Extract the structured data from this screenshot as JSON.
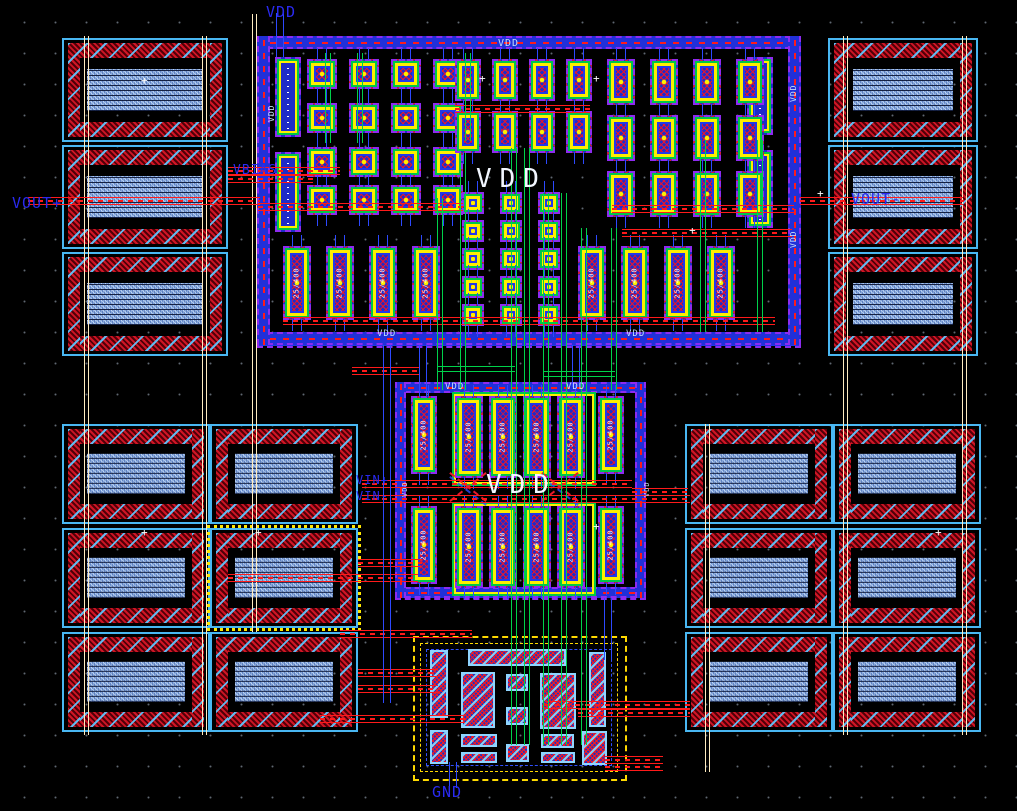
{
  "canvas": {
    "width": 1017,
    "height": 811,
    "description": "IC layout editor canvas, black background with dot grid"
  },
  "colors": {
    "background": "#000000",
    "grid_dot": "#9fb4c8",
    "purple": "#8d2bf0",
    "blue": "#2338e8",
    "light_blue": "#49b7f2",
    "green": "#00c845",
    "yellow": "#ffee00",
    "red": "#ff1a1a",
    "dark_red": "#500008",
    "cream": "#ffecc0",
    "white": "#f2f6ff",
    "label_blue": "#2a2af0",
    "select_yellow": "#ffe800"
  },
  "device_label": "25/400",
  "marker_glyph": "+",
  "texts": [
    {
      "label": "VDD",
      "x": 266,
      "y": 5,
      "size": 15,
      "color": "blue",
      "name": "net-label-vdd-top"
    },
    {
      "label": "VDD",
      "x": 498,
      "y": 39,
      "size": 10,
      "color": "lt",
      "name": "rail-label-vdd-top"
    },
    {
      "label": "VBIAS",
      "x": 233,
      "y": 164,
      "size": 13,
      "color": "blue",
      "name": "net-label-vbias"
    },
    {
      "label": "VOUT+",
      "x": 12,
      "y": 196,
      "size": 15,
      "color": "blue",
      "name": "net-label-vout-plus"
    },
    {
      "label": "VOUT-",
      "x": 851,
      "y": 192,
      "size": 15,
      "color": "blue",
      "name": "net-label-vout-minus"
    },
    {
      "label": "VDD",
      "x": 476,
      "y": 166,
      "size": 26,
      "color": "white",
      "spacing": 8,
      "name": "power-label-vdd-topblock"
    },
    {
      "label": "VDD",
      "x": 486,
      "y": 472,
      "size": 26,
      "color": "white",
      "spacing": 8,
      "name": "power-label-vdd-midblock"
    },
    {
      "label": "VIN+",
      "x": 356,
      "y": 474,
      "size": 12,
      "color": "blue",
      "name": "net-label-vin-plus"
    },
    {
      "label": "VIN-",
      "x": 356,
      "y": 490,
      "size": 12,
      "color": "blue",
      "name": "net-label-vin-minus"
    },
    {
      "label": "GND",
      "x": 432,
      "y": 785,
      "size": 15,
      "color": "blue",
      "name": "net-label-gnd"
    },
    {
      "label": "VDD",
      "x": 377,
      "y": 330,
      "size": 9,
      "color": "lt",
      "name": "rail-label-vdd-bottomleft"
    },
    {
      "label": "VDD",
      "x": 626,
      "y": 330,
      "size": 9,
      "color": "lt",
      "name": "rail-label-vdd-bottomright"
    },
    {
      "label": "VDD",
      "x": 445,
      "y": 383,
      "size": 9,
      "color": "lt",
      "name": "rail-label-vdd-midleft"
    },
    {
      "label": "VDD",
      "x": 566,
      "y": 383,
      "size": 9,
      "color": "lt",
      "name": "rail-label-vdd-midright"
    },
    {
      "label": "VDD",
      "x": 790,
      "y": 102,
      "size": 8,
      "color": "lt",
      "rot": -90,
      "name": "rail-label-vdd-right1"
    },
    {
      "label": "VDD",
      "x": 790,
      "y": 248,
      "size": 8,
      "color": "lt",
      "rot": -90,
      "name": "rail-label-vdd-right2"
    },
    {
      "label": "VDD",
      "x": 268,
      "y": 122,
      "size": 8,
      "color": "lt",
      "rot": -90,
      "name": "rail-label-vdd-left1"
    },
    {
      "label": "VDD",
      "x": 402,
      "y": 497,
      "size": 7,
      "color": "lt",
      "rot": -90,
      "name": "port-label-mid-left"
    },
    {
      "label": "VDD",
      "x": 644,
      "y": 497,
      "size": 7,
      "color": "lt",
      "rot": -90,
      "name": "port-label-mid-right"
    }
  ],
  "top_block_cells": {
    "bias": [
      [
        275,
        57,
        26,
        80
      ],
      [
        275,
        152,
        26,
        80
      ],
      [
        747,
        57,
        26,
        78
      ],
      [
        747,
        150,
        26,
        78
      ]
    ],
    "sq": {
      "w": 30,
      "h": 30,
      "pts": [
        [
          307,
          59
        ],
        [
          349,
          59
        ],
        [
          391,
          59
        ],
        [
          433,
          59
        ],
        [
          307,
          103
        ],
        [
          349,
          103
        ],
        [
          391,
          103
        ],
        [
          433,
          103
        ],
        [
          307,
          147
        ],
        [
          349,
          147
        ],
        [
          391,
          147
        ],
        [
          433,
          147
        ],
        [
          307,
          185
        ],
        [
          349,
          185
        ],
        [
          391,
          185
        ],
        [
          433,
          185
        ]
      ]
    },
    "vcell_center": {
      "w": 26,
      "h": 42,
      "pts": [
        [
          455,
          59
        ],
        [
          492,
          59
        ],
        [
          529,
          59
        ],
        [
          566,
          59
        ],
        [
          455,
          111
        ],
        [
          492,
          111
        ],
        [
          529,
          111
        ],
        [
          566,
          111
        ]
      ]
    },
    "sq_small": {
      "w": 22,
      "h": 22,
      "pts": [
        [
          462,
          192
        ],
        [
          500,
          192
        ],
        [
          538,
          192
        ],
        [
          462,
          220
        ],
        [
          500,
          220
        ],
        [
          538,
          220
        ],
        [
          462,
          248
        ],
        [
          500,
          248
        ],
        [
          538,
          248
        ],
        [
          462,
          276
        ],
        [
          500,
          276
        ],
        [
          538,
          276
        ],
        [
          462,
          304
        ],
        [
          500,
          304
        ],
        [
          538,
          304
        ]
      ]
    },
    "vcell_right": {
      "w": 28,
      "h": 46,
      "pts": [
        [
          607,
          59
        ],
        [
          650,
          59
        ],
        [
          693,
          59
        ],
        [
          736,
          59
        ],
        [
          607,
          115
        ],
        [
          650,
          115
        ],
        [
          693,
          115
        ],
        [
          736,
          115
        ],
        [
          607,
          171
        ],
        [
          650,
          171
        ],
        [
          693,
          171
        ],
        [
          736,
          171
        ]
      ]
    },
    "tall": {
      "w": 28,
      "h": 74,
      "y": 246,
      "xs": [
        283,
        326,
        369,
        412,
        578,
        621,
        664,
        707
      ]
    }
  },
  "middle_block_cells": {
    "narrow": {
      "w": 26,
      "h": 78,
      "pts": [
        [
          411,
          396
        ],
        [
          598,
          396
        ],
        [
          411,
          506
        ],
        [
          598,
          506
        ]
      ]
    },
    "wide": {
      "w": 28,
      "h": 82,
      "pts": [
        [
          455,
          396
        ],
        [
          489,
          396
        ],
        [
          523,
          396
        ],
        [
          557,
          396
        ],
        [
          455,
          506
        ],
        [
          489,
          506
        ],
        [
          523,
          506
        ],
        [
          557,
          506
        ]
      ]
    },
    "rings": [
      [
        452,
        392,
        140,
        90
      ],
      [
        452,
        502,
        140,
        90
      ]
    ]
  },
  "bottom_block_cells": [
    [
      430,
      650,
      18,
      68
    ],
    [
      430,
      730,
      18,
      34
    ],
    [
      468,
      649,
      98,
      17
    ],
    [
      461,
      672,
      34,
      56
    ],
    [
      506,
      674,
      22,
      17
    ],
    [
      506,
      707,
      22,
      18
    ],
    [
      540,
      673,
      36,
      56
    ],
    [
      589,
      652,
      17,
      75
    ],
    [
      461,
      734,
      36,
      13
    ],
    [
      461,
      752,
      36,
      11
    ],
    [
      506,
      744,
      23,
      18
    ],
    [
      541,
      734,
      33,
      14
    ],
    [
      541,
      752,
      34,
      11
    ],
    [
      582,
      731,
      25,
      34
    ]
  ],
  "capacitors": {
    "units": [
      [
        62,
        38,
        166,
        104
      ],
      [
        62,
        145,
        166,
        104
      ],
      [
        62,
        252,
        166,
        104
      ],
      [
        828,
        38,
        150,
        104
      ],
      [
        828,
        145,
        150,
        104
      ],
      [
        828,
        252,
        150,
        104
      ],
      [
        62,
        424,
        148,
        100
      ],
      [
        210,
        424,
        148,
        100
      ],
      [
        62,
        528,
        148,
        100
      ],
      [
        210,
        528,
        148,
        100
      ],
      [
        62,
        632,
        148,
        100
      ],
      [
        210,
        632,
        148,
        100
      ],
      [
        685,
        424,
        148,
        100
      ],
      [
        833,
        424,
        148,
        100
      ],
      [
        685,
        528,
        148,
        100
      ],
      [
        833,
        528,
        148,
        100
      ],
      [
        685,
        632,
        148,
        100
      ],
      [
        833,
        632,
        148,
        100
      ]
    ],
    "selected_index": 9
  },
  "bowties": [
    [
      445,
      468
    ],
    [
      537,
      468
    ]
  ],
  "wires": {
    "red": [
      [
        28,
        197,
        232
      ],
      [
        258,
        203,
        205
      ],
      [
        800,
        197,
        163
      ],
      [
        228,
        167,
        112
      ],
      [
        228,
        175,
        85
      ],
      [
        455,
        105,
        135
      ],
      [
        612,
        205,
        182
      ],
      [
        622,
        229,
        170
      ],
      [
        283,
        317,
        492
      ],
      [
        352,
        367,
        68
      ],
      [
        362,
        480,
        270
      ],
      [
        362,
        495,
        328
      ],
      [
        632,
        488,
        56
      ],
      [
        358,
        559,
        64
      ],
      [
        228,
        574,
        190
      ],
      [
        340,
        630,
        132
      ],
      [
        358,
        669,
        80
      ],
      [
        358,
        685,
        80
      ],
      [
        320,
        715,
        145
      ],
      [
        545,
        701,
        145
      ],
      [
        578,
        709,
        112
      ],
      [
        605,
        756,
        58
      ],
      [
        605,
        763,
        58
      ]
    ],
    "green_v": [
      [
        437,
        198,
        192
      ],
      [
        460,
        153,
        237
      ],
      [
        511,
        148,
        597
      ],
      [
        524,
        148,
        597
      ],
      [
        543,
        193,
        552
      ],
      [
        561,
        193,
        552
      ],
      [
        581,
        228,
        517
      ],
      [
        611,
        228,
        162
      ],
      [
        325,
        53,
        90
      ],
      [
        357,
        53,
        90
      ],
      [
        465,
        53,
        88
      ],
      [
        700,
        140,
        192
      ],
      [
        757,
        140,
        192
      ]
    ],
    "green_h": [
      [
        437,
        366,
        78
      ],
      [
        543,
        371,
        72
      ]
    ],
    "blue_v": [
      [
        276,
        13,
        44
      ],
      [
        383,
        345,
        358
      ],
      [
        419,
        345,
        52
      ],
      [
        572,
        345,
        42
      ],
      [
        604,
        598,
        62
      ],
      [
        449,
        762,
        26
      ]
    ],
    "cream_v": [
      [
        84,
        36,
        699
      ],
      [
        202,
        36,
        699
      ],
      [
        252,
        14,
        618
      ],
      [
        705,
        424,
        348
      ],
      [
        843,
        36,
        699
      ],
      [
        962,
        36,
        699
      ]
    ]
  },
  "markers": [
    [
      141,
      75
    ],
    [
      479,
      73
    ],
    [
      593,
      73
    ],
    [
      817,
      188
    ],
    [
      141,
      527
    ],
    [
      255,
      527
    ],
    [
      593,
      521
    ],
    [
      935,
      527
    ],
    [
      689,
      225
    ]
  ]
}
